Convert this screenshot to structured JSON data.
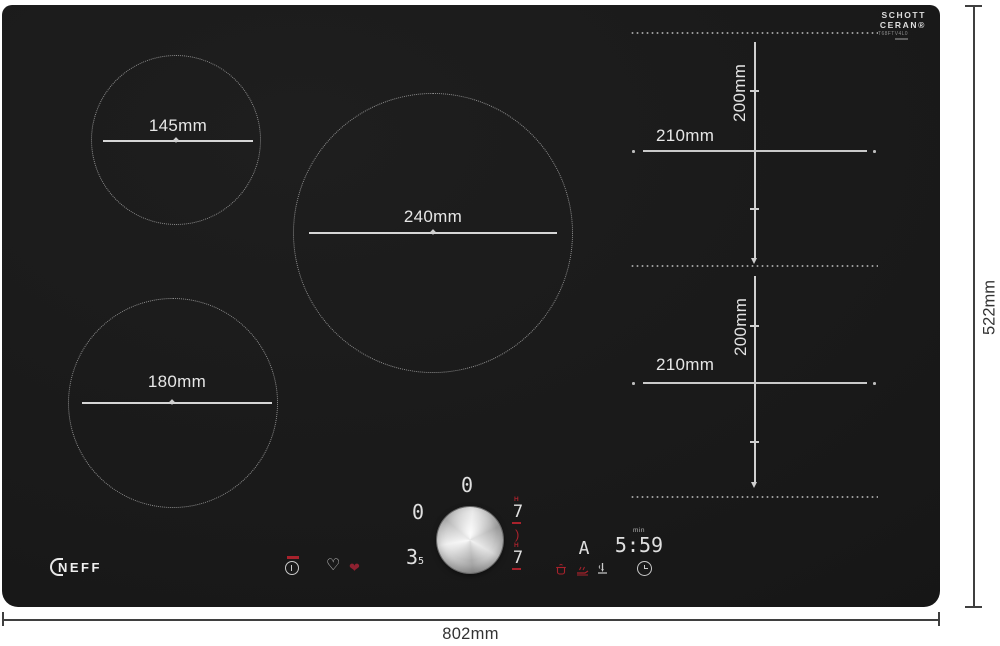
{
  "brand": {
    "logo": "NEFF"
  },
  "glass": {
    "maker_line1": "SCHOTT",
    "maker_line2": "CERAN®",
    "model": "T68FTV4L0"
  },
  "outer_dims": {
    "width": "802mm",
    "height": "522mm"
  },
  "zones": {
    "circles": [
      {
        "id": "rear-left",
        "label": "145mm"
      },
      {
        "id": "center",
        "label": "240mm"
      },
      {
        "id": "front-left",
        "label": "180mm"
      }
    ],
    "flex": [
      {
        "id": "right-rear",
        "width_label": "210mm",
        "height_label": "200mm"
      },
      {
        "id": "right-front",
        "width_label": "210mm",
        "height_label": "200mm"
      }
    ]
  },
  "panel": {
    "displays": {
      "zone_left": "0",
      "zone_rear": "0",
      "power_main": "3",
      "power_sub": "5",
      "flex_rear_heat": "H",
      "flex_rear_level": "7",
      "bridge_arc": ")",
      "flex_front_heat": "H",
      "flex_front_level": "7",
      "auto": "A",
      "timer_unit": "min",
      "timer": "5:59"
    },
    "glyphs": {
      "heart_outline": "♡",
      "heart_filled": "❤"
    },
    "icon_names": [
      "power-icon",
      "favourite-heart-icon",
      "active-heart-icon",
      "pot-sensor-icon",
      "frying-sensor-icon",
      "cooking-sensor-icon",
      "timer-clock-icon"
    ],
    "colors": {
      "accent_red": "#a8222c",
      "display_white": "#e0e0e0"
    }
  },
  "colors": {
    "surface": "#1a1a1a",
    "zone_outline": "#9a9a9a",
    "dimension_on_glass": "#d9d9d9",
    "dimension_outside": "#333333",
    "background": "#ffffff"
  }
}
